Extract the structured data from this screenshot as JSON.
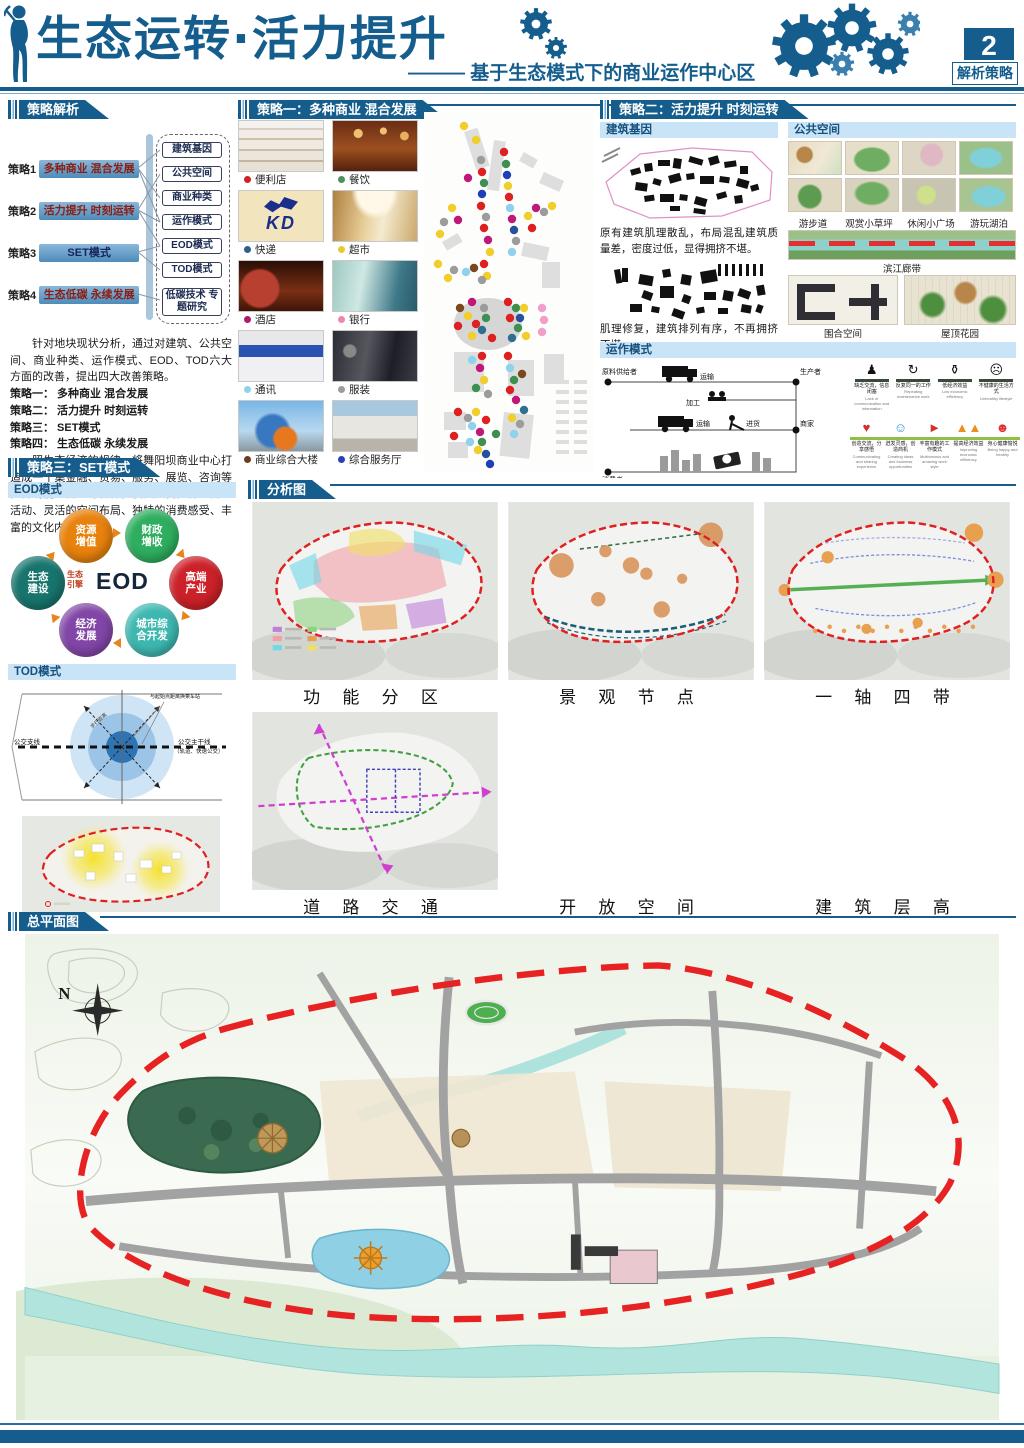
{
  "header": {
    "title": "生态运转·活力提升",
    "subtitle": "——— 基于生态模式下的商业运作中心区",
    "page_number": "2",
    "page_label": "解析策略"
  },
  "strategy_analysis": {
    "section_title": "策略解析",
    "strategies": [
      {
        "prefix": "策略1",
        "label": "多种商业 混合发展"
      },
      {
        "prefix": "策略2",
        "label": "活力提升 时刻运转"
      },
      {
        "prefix": "策略3",
        "label": "SET模式"
      },
      {
        "prefix": "策略4",
        "label": "生态低碳 永续发展"
      }
    ],
    "aspects": [
      "建筑基因",
      "公共空间",
      "商业种类",
      "运作模式",
      "EOD模式",
      "TOD模式",
      "低碳技术 专题研究"
    ],
    "paragraph1": "针对地块现状分析，通过对建筑、公共空间、商业种类、运作模式、EOD、TOD六大方面的改善，提出四大改善策略。",
    "list_lines": [
      "策略一： 多种商业 混合发展",
      "策略二： 活力提升 时刻运转",
      "策略三： SET模式",
      "策略四： 生态低碳 永续发展"
    ],
    "paragraph2": "照生态经济的规律，将舞阳坝商业中心打造成一个集金融、贸易、服务、展览、咨询等多种功能的商业综合体，使其具备多样的商业活动、灵活的空间布局、独特的消费感受、丰富的文化内涵。"
  },
  "strategy_one": {
    "section_title": "策略一：多种商业 混合发展",
    "kd_label": "KD",
    "items": [
      {
        "label": "便利店",
        "dot": "#cc2222"
      },
      {
        "label": "餐饮",
        "dot": "#4e8f5e"
      },
      {
        "label": "快递",
        "dot": "#2c5f8e"
      },
      {
        "label": "超市",
        "dot": "#e8c930"
      },
      {
        "label": "酒店",
        "dot": "#b0186a"
      },
      {
        "label": "银行",
        "dot": "#ee86b4"
      },
      {
        "label": "通讯",
        "dot": "#8fd2ee"
      },
      {
        "label": "服装",
        "dot": "#9c9c9c"
      },
      {
        "label": "商业综合大楼",
        "dot": "#6e3b1c"
      },
      {
        "label": "综合服务厅",
        "dot": "#2a3fb8"
      }
    ],
    "dot_palette": {
      "r": "#dd2020",
      "g": "#3f8f52",
      "y": "#f0cf2c",
      "b": "#1f3fb8",
      "nb": "#27519e",
      "m": "#c01878",
      "gy": "#9c9c9c",
      "c": "#8fd2ee",
      "br": "#7a481e",
      "p": "#f0a0c8",
      "t": "#2f7090"
    },
    "map_dots": [
      [
        40,
        14,
        "y"
      ],
      [
        52,
        28,
        "y"
      ],
      [
        57,
        48,
        "gy"
      ],
      [
        58,
        60,
        "r"
      ],
      [
        60,
        71,
        "g"
      ],
      [
        58,
        82,
        "b"
      ],
      [
        44,
        66,
        "m"
      ],
      [
        57,
        94,
        "r"
      ],
      [
        62,
        105,
        "gy"
      ],
      [
        60,
        116,
        "r"
      ],
      [
        64,
        128,
        "m"
      ],
      [
        66,
        140,
        "y"
      ],
      [
        60,
        152,
        "r"
      ],
      [
        63,
        164,
        "y"
      ],
      [
        80,
        40,
        "r"
      ],
      [
        82,
        52,
        "g"
      ],
      [
        83,
        63,
        "b"
      ],
      [
        84,
        74,
        "y"
      ],
      [
        85,
        85,
        "r"
      ],
      [
        86,
        96,
        "c"
      ],
      [
        88,
        107,
        "m"
      ],
      [
        90,
        118,
        "nb"
      ],
      [
        92,
        129,
        "gy"
      ],
      [
        88,
        140,
        "c"
      ],
      [
        28,
        96,
        "y"
      ],
      [
        20,
        110,
        "gy"
      ],
      [
        34,
        108,
        "m"
      ],
      [
        16,
        122,
        "y"
      ],
      [
        104,
        104,
        "y"
      ],
      [
        112,
        96,
        "m"
      ],
      [
        120,
        100,
        "gy"
      ],
      [
        128,
        94,
        "y"
      ],
      [
        108,
        116,
        "r"
      ],
      [
        14,
        152,
        "y"
      ],
      [
        30,
        158,
        "gy"
      ],
      [
        42,
        160,
        "c"
      ],
      [
        50,
        156,
        "br"
      ],
      [
        24,
        166,
        "y"
      ],
      [
        58,
        168,
        "gy"
      ],
      [
        36,
        196,
        "br"
      ],
      [
        48,
        190,
        "m"
      ],
      [
        44,
        204,
        "y"
      ],
      [
        52,
        212,
        "r"
      ],
      [
        34,
        214,
        "r"
      ],
      [
        60,
        196,
        "gy"
      ],
      [
        62,
        206,
        "g"
      ],
      [
        58,
        218,
        "t"
      ],
      [
        48,
        224,
        "y"
      ],
      [
        68,
        226,
        "r"
      ],
      [
        84,
        190,
        "r"
      ],
      [
        92,
        196,
        "g"
      ],
      [
        96,
        206,
        "nb"
      ],
      [
        86,
        206,
        "r"
      ],
      [
        100,
        196,
        "y"
      ],
      [
        94,
        216,
        "g"
      ],
      [
        88,
        226,
        "t"
      ],
      [
        102,
        224,
        "y"
      ],
      [
        118,
        196,
        "p"
      ],
      [
        120,
        208,
        "p"
      ],
      [
        118,
        220,
        "p"
      ],
      [
        48,
        248,
        "c"
      ],
      [
        58,
        244,
        "r"
      ],
      [
        56,
        256,
        "m"
      ],
      [
        60,
        268,
        "y"
      ],
      [
        52,
        276,
        "g"
      ],
      [
        64,
        282,
        "gy"
      ],
      [
        84,
        244,
        "r"
      ],
      [
        86,
        256,
        "c"
      ],
      [
        90,
        268,
        "g"
      ],
      [
        98,
        262,
        "br"
      ],
      [
        86,
        278,
        "r"
      ],
      [
        92,
        288,
        "m"
      ],
      [
        34,
        300,
        "r"
      ],
      [
        44,
        306,
        "gy"
      ],
      [
        52,
        300,
        "y"
      ],
      [
        48,
        314,
        "c"
      ],
      [
        56,
        320,
        "m"
      ],
      [
        62,
        308,
        "r"
      ],
      [
        58,
        330,
        "g"
      ],
      [
        62,
        342,
        "nb"
      ],
      [
        54,
        338,
        "y"
      ],
      [
        46,
        330,
        "c"
      ],
      [
        66,
        352,
        "b"
      ],
      [
        30,
        324,
        "r"
      ],
      [
        72,
        322,
        "g"
      ],
      [
        88,
        306,
        "y"
      ],
      [
        96,
        312,
        "gy"
      ],
      [
        90,
        322,
        "c"
      ],
      [
        100,
        298,
        "t"
      ]
    ]
  },
  "strategy_two": {
    "section_title": "策略二：活力提升 时刻运转",
    "building_gene": {
      "title": "建筑基因",
      "caption1": "原有建筑肌理散乱，布局混乱建筑质量差，密度过低，显得拥挤不堪。",
      "caption2": "肌理修复，建筑排列有序，不再拥挤不堪。"
    },
    "public_space": {
      "title": "公共空间",
      "labels": [
        "游步道",
        "观赏小草坪",
        "休闲小广场",
        "游玩湖泊"
      ],
      "riverside": "滨江廊带",
      "others": [
        "围合空间",
        "屋顶花园"
      ]
    },
    "operation": {
      "title": "运作模式",
      "flow": {
        "supplier": "原料供给者",
        "transport1": "运输",
        "producer": "生产者",
        "process": "加工",
        "transport2": "运输",
        "purchase": "进货",
        "merchant": "商家",
        "consumer": "消费者"
      },
      "negatives": [
        {
          "zh": "缺乏交流，信息闭塞",
          "en": "Lack of communication and information"
        },
        {
          "zh": "反复同一的工作",
          "en": "Repeating maintenance work"
        },
        {
          "zh": "低经济效益",
          "en": "Low economic efficiency"
        },
        {
          "zh": "不健康的生活方式",
          "en": "Unhealthy lifestyle"
        }
      ],
      "positives": [
        {
          "zh": "创造交流，分享感悟",
          "en": "Communicating and sharing experience"
        },
        {
          "zh": "迸发灵感，创造商机",
          "en": "Creating ideas and business opportunities"
        },
        {
          "zh": "丰富有趣的工作模式",
          "en": "Multivarious and amazing work style"
        },
        {
          "zh": "提高经济效益",
          "en": "Improving economic efficiency"
        },
        {
          "zh": "身心健康愉悦",
          "en": "Being happy and healthy"
        }
      ]
    }
  },
  "strategy_three": {
    "section_title": "策略三：SET模式",
    "eod": {
      "title": "EOD模式",
      "center": "EOD",
      "engine_label": "生态引擎",
      "nodes": [
        {
          "label": "资源增值",
          "color": "#e8820c"
        },
        {
          "label": "财政增收",
          "color": "#2eae5e"
        },
        {
          "label": "高端产业",
          "color": "#cc2128"
        },
        {
          "label": "城市综合开发",
          "color": "#3db8b0"
        },
        {
          "label": "经济发展",
          "color": "#8246a8"
        },
        {
          "label": "生态建设",
          "color": "#17756d"
        }
      ]
    },
    "tod": {
      "title": "TOD模式",
      "left_label": "公交支线",
      "right_label1": "公交主干线",
      "right_label2": "（轨道、快速公交）",
      "station_label": "与起始点距离换乘车站",
      "walk_label": "步行距离"
    }
  },
  "analysis": {
    "section_title": "分析图",
    "maps": [
      {
        "caption": "功 能 分 区"
      },
      {
        "caption": "景 观 节 点"
      },
      {
        "caption": "一 轴 四 带"
      },
      {
        "caption": "道 路 交 通"
      },
      {
        "caption": "开 放 空 间"
      },
      {
        "caption": "建 筑 层 高"
      }
    ]
  },
  "master_plan": {
    "section_title": "总平面图",
    "north_label": "N",
    "callouts": [
      {
        "text": "学校",
        "lx": 408,
        "ly": 16,
        "px": 428,
        "py": 88
      },
      {
        "text": "居住区",
        "lx": 592,
        "ly": 22,
        "px": 650,
        "py": 96
      },
      {
        "text": "建筑综合体",
        "lx": 728,
        "ly": 34,
        "px": 628,
        "py": 162
      },
      {
        "text": "居住区",
        "lx": 26,
        "ly": 180,
        "px": 132,
        "py": 220
      },
      {
        "text": "游玩人工湖",
        "lx": 186,
        "ly": 412,
        "px": 334,
        "py": 348
      },
      {
        "text": "清江生态廊带",
        "lx": 348,
        "ly": 424,
        "px": 412,
        "py": 372
      },
      {
        "text": "屋顶花园",
        "lx": 516,
        "ly": 446,
        "px": 592,
        "py": 330
      },
      {
        "text": "民族大礼堂",
        "lx": 598,
        "ly": 444,
        "px": 626,
        "py": 348
      }
    ],
    "floor_tags": [
      {
        "t": "5F",
        "x": 316,
        "y": 66
      },
      {
        "t": "3F",
        "x": 404,
        "y": 92
      },
      {
        "t": "5F",
        "x": 362,
        "y": 118
      },
      {
        "t": "7F",
        "x": 382,
        "y": 152
      },
      {
        "t": "4F",
        "x": 476,
        "y": 148
      },
      {
        "t": "8F",
        "x": 512,
        "y": 120
      },
      {
        "t": "5F",
        "x": 292,
        "y": 146
      },
      {
        "t": "3F",
        "x": 540,
        "y": 86
      },
      {
        "t": "5F",
        "x": 590,
        "y": 112
      },
      {
        "t": "5F",
        "x": 586,
        "y": 152
      },
      {
        "t": "18F",
        "x": 668,
        "y": 168
      },
      {
        "t": "13F",
        "x": 636,
        "y": 192
      },
      {
        "t": "20F",
        "x": 742,
        "y": 200
      },
      {
        "t": "15F",
        "x": 700,
        "y": 224
      },
      {
        "t": "18F",
        "x": 752,
        "y": 230
      },
      {
        "t": "3F",
        "x": 748,
        "y": 162
      },
      {
        "t": "5F",
        "x": 112,
        "y": 236
      },
      {
        "t": "6F",
        "x": 128,
        "y": 262
      },
      {
        "t": "8F",
        "x": 230,
        "y": 240
      },
      {
        "t": "8F",
        "x": 288,
        "y": 234
      },
      {
        "t": "6F",
        "x": 240,
        "y": 268
      },
      {
        "t": "6F",
        "x": 340,
        "y": 256
      },
      {
        "t": "10F",
        "x": 530,
        "y": 230
      },
      {
        "t": "3F",
        "x": 470,
        "y": 228
      },
      {
        "t": "10F",
        "x": 436,
        "y": 292
      },
      {
        "t": "6F",
        "x": 520,
        "y": 300
      },
      {
        "t": "8F",
        "x": 700,
        "y": 292
      },
      {
        "t": "6F",
        "x": 762,
        "y": 284
      },
      {
        "t": "5F",
        "x": 822,
        "y": 292
      },
      {
        "t": "3F",
        "x": 600,
        "y": 316
      },
      {
        "t": "6F",
        "x": 660,
        "y": 314
      },
      {
        "t": "4F",
        "x": 820,
        "y": 352
      },
      {
        "t": "3F",
        "x": 380,
        "y": 356
      },
      {
        "t": "10F",
        "x": 448,
        "y": 318
      }
    ]
  }
}
